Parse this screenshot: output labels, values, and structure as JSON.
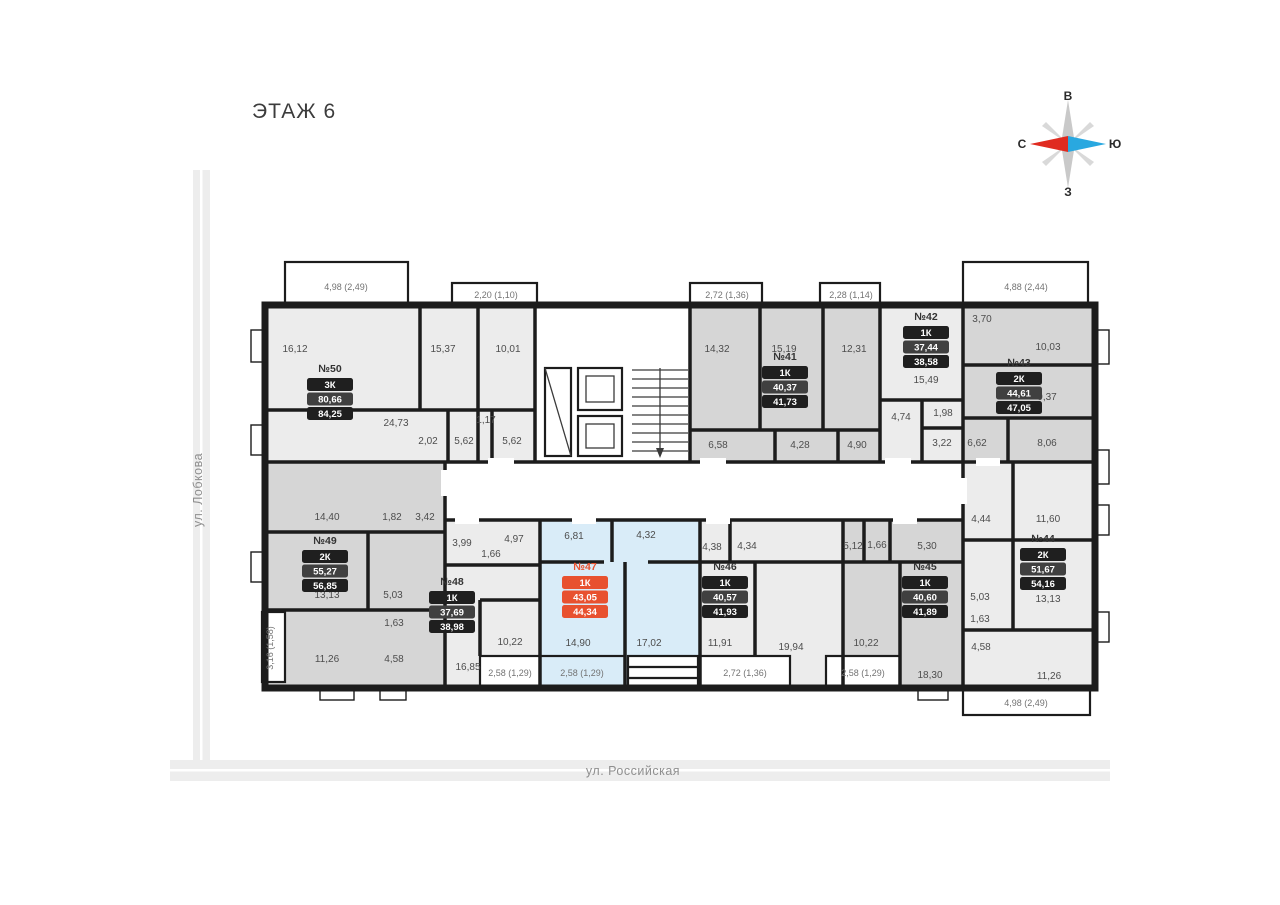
{
  "page": {
    "floor_title": "ЭТАЖ 6"
  },
  "compass": {
    "top": "В",
    "right": "Ю",
    "bottom": "З",
    "left": "С"
  },
  "streets": {
    "left": "ул. Лобкова",
    "bottom": "ул. Российская"
  },
  "colors": {
    "highlight": "#e8512f",
    "unit_light": "#ececec",
    "unit_dark": "#d6d6d6",
    "unit_highlight_fill": "#d9ecf8",
    "wall": "#1c1c1c"
  },
  "apartments": [
    {
      "id": "50",
      "number": "№50",
      "type": "3К",
      "area_total": "80,66",
      "area_with_balcony": "84,25",
      "highlighted": false
    },
    {
      "id": "41",
      "number": "№41",
      "type": "1К",
      "area_total": "40,37",
      "area_with_balcony": "41,73",
      "highlighted": false
    },
    {
      "id": "42",
      "number": "№42",
      "type": "1К",
      "area_total": "37,44",
      "area_with_balcony": "38,58",
      "highlighted": false
    },
    {
      "id": "43",
      "number": "№43",
      "type": "2К",
      "area_total": "44,61",
      "area_with_balcony": "47,05",
      "highlighted": false
    },
    {
      "id": "49",
      "number": "№49",
      "type": "2К",
      "area_total": "55,27",
      "area_with_balcony": "56,85",
      "highlighted": false
    },
    {
      "id": "48",
      "number": "№48",
      "type": "1К",
      "area_total": "37,69",
      "area_with_balcony": "38,98",
      "highlighted": false
    },
    {
      "id": "47",
      "number": "№47",
      "type": "1К",
      "area_total": "43,05",
      "area_with_balcony": "44,34",
      "highlighted": true
    },
    {
      "id": "46",
      "number": "№46",
      "type": "1К",
      "area_total": "40,57",
      "area_with_balcony": "41,93",
      "highlighted": false
    },
    {
      "id": "45",
      "number": "№45",
      "type": "1К",
      "area_total": "40,60",
      "area_with_balcony": "41,89",
      "highlighted": false
    },
    {
      "id": "44",
      "number": "№44",
      "type": "2К",
      "area_total": "51,67",
      "area_with_balcony": "54,16",
      "highlighted": false
    }
  ],
  "plan": {
    "room_labels": [
      "16,12",
      "15,37",
      "10,01",
      "24,73",
      "2,02",
      "1,17",
      "5,62",
      "5,62",
      "14,32",
      "15,19",
      "12,31",
      "6,58",
      "4,28",
      "4,90",
      "15,49",
      "3,70",
      "4,74",
      "1,98",
      "3,22",
      "10,03",
      "9,37",
      "6,62",
      "8,06",
      "14,40",
      "1,82",
      "3,42",
      "13,13",
      "5,03",
      "1,63",
      "11,26",
      "4,58",
      "3,99",
      "10,22",
      "16,85",
      "4,97",
      "1,66",
      "6,81",
      "4,32",
      "14,90",
      "17,02",
      "4,38",
      "4,34",
      "11,91",
      "19,94",
      "5,12",
      "1,66",
      "10,22",
      "5,30",
      "18,30",
      "4,44",
      "11,60",
      "5,03",
      "1,63",
      "4,58",
      "13,13",
      "11,26"
    ],
    "balcony_labels": [
      "4,98 (2,49)",
      "2,20 (1,10)",
      "2,72 (1,36)",
      "2,28 (1,14)",
      "4,88 (2,44)",
      "3,16 (1,58)",
      "2,58 (1,29)",
      "2,58 (1,29)",
      "2,72 (1,36)",
      "2,58 (1,29)",
      "4,98 (2,49)"
    ]
  }
}
